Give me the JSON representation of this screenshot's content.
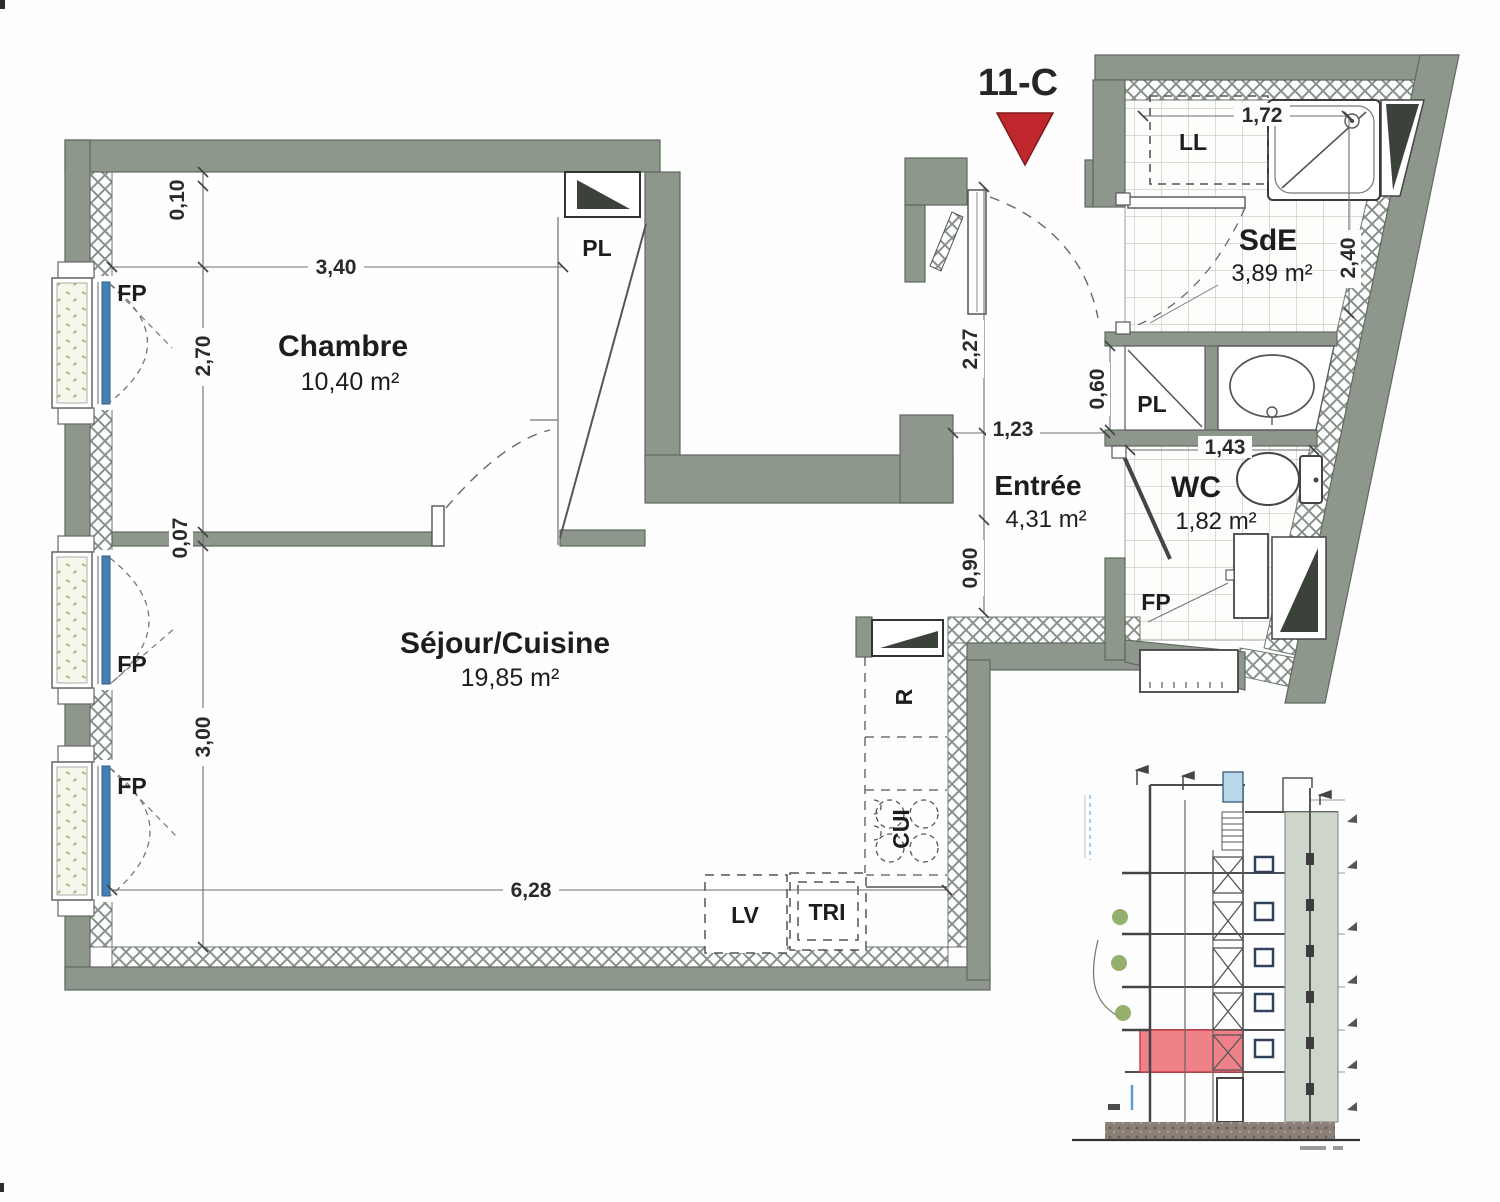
{
  "unit": {
    "label": "11-C"
  },
  "rooms": {
    "chambre": {
      "name": "Chambre",
      "area": "10,40 m²"
    },
    "sejour": {
      "name": "Séjour/Cuisine",
      "area": "19,85 m²"
    },
    "entree": {
      "name": "Entrée",
      "area": "4,31 m²"
    },
    "sde": {
      "name": "SdE",
      "area": "3,89 m²"
    },
    "wc": {
      "name": "WC",
      "area": "1,82 m²"
    }
  },
  "fixtures": {
    "closet_chambre": "PL",
    "closet_sde": "PL",
    "washing_machine": "LL",
    "dishwasher": "LV",
    "sorting_bin": "TRI",
    "cooktop": "CUI",
    "fridge": "R",
    "window_chambre": "FP",
    "window_sejour_1": "FP",
    "window_sejour_2": "FP",
    "window_wc": "FP"
  },
  "dimensions": {
    "chambre_offset_top": "0,10",
    "chambre_width": "3,40",
    "chambre_height": "2,70",
    "partition_thickness": "0,07",
    "sejour_height": "3,00",
    "sejour_width": "6,28",
    "entree_upper": "2,27",
    "entree_lower": "0,90",
    "entree_width": "1,23",
    "sde_width": "1,72",
    "sde_height": "2,40",
    "closet_sde_depth": "0,60",
    "wc_width": "1,43"
  },
  "colors": {
    "wall": "#8e978b",
    "marker_red": "#c0272d",
    "highlight_red": "#ef8289",
    "glazing_blue": "#4381b5"
  }
}
